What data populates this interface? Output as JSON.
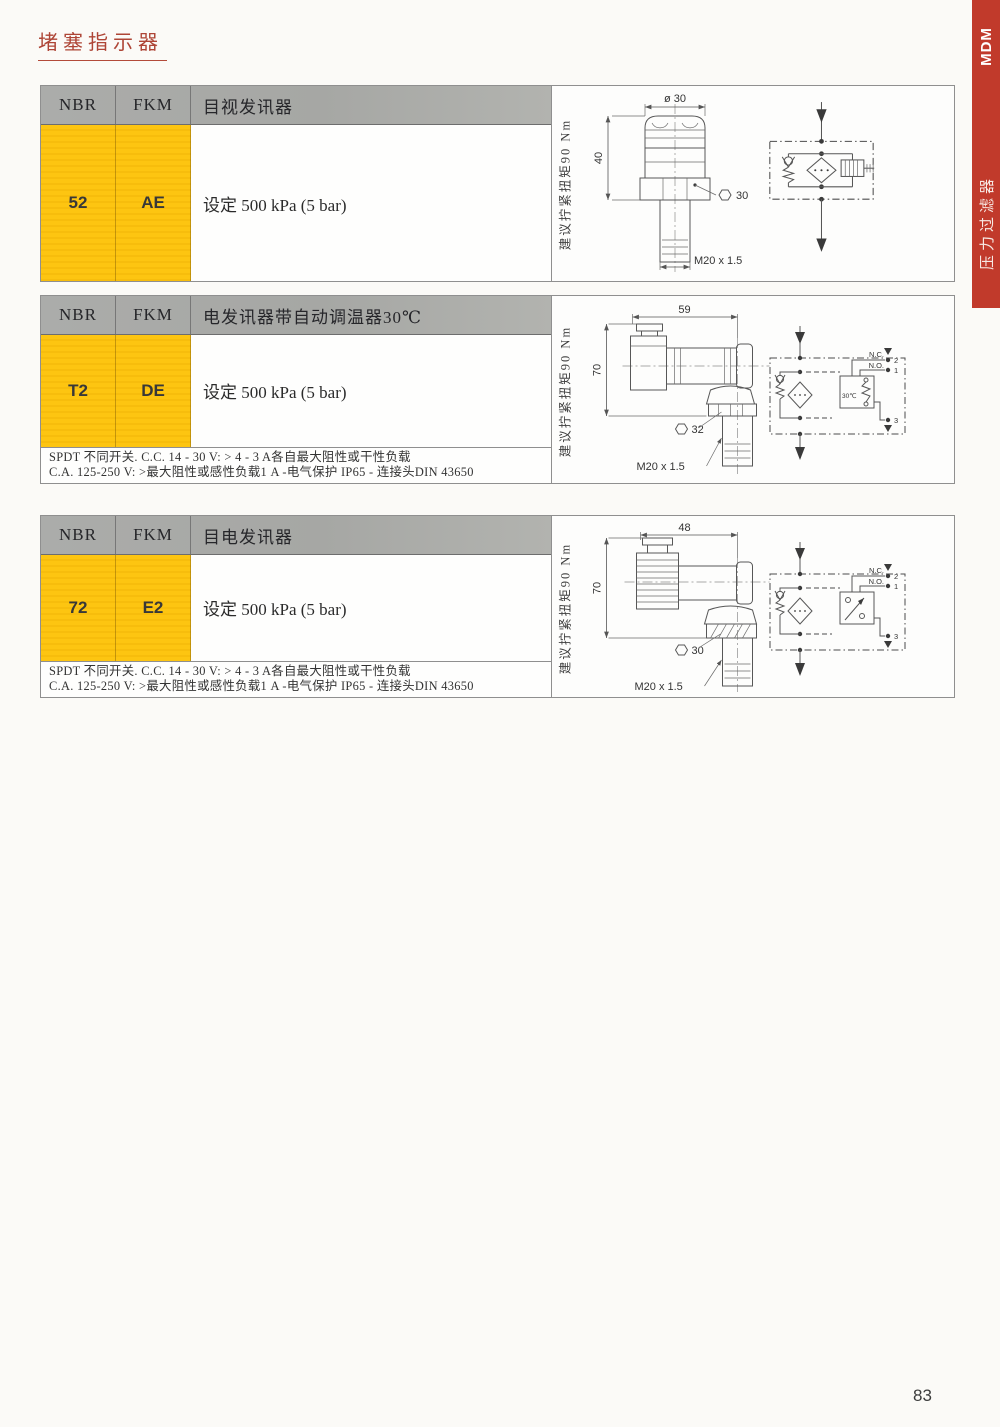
{
  "page": {
    "title": "堵塞指示器",
    "number": "83"
  },
  "sidebar": {
    "brand": "MDM",
    "category": "压力过滤器"
  },
  "colors": {
    "accent_red": "#c13a2b",
    "header_gray": "#a9aaa7",
    "cell_yellow": "#fdc511",
    "title_red": "#ae4536"
  },
  "sections": [
    {
      "header": {
        "nbr": "NBR",
        "fkm": "FKM",
        "title": "目视发讯器"
      },
      "row": {
        "nbr": "52",
        "fkm": "AE",
        "desc": "设定 500 kPa (5 bar)"
      },
      "torque": "建议拧紧扭矩90 Nm",
      "drawing": {
        "dim_top": "ø 30",
        "height": "40",
        "hex": "30",
        "thread": "M20 x 1.5"
      }
    },
    {
      "header": {
        "nbr": "NBR",
        "fkm": "FKM",
        "title": "电发讯器带自动调温器30℃"
      },
      "row": {
        "nbr": "T2",
        "fkm": "DE",
        "desc": "设定 500 kPa (5 bar)"
      },
      "notes": [
        "SPDT 不同开关. C.C. 14 - 30 V: > 4 - 3 A各自最大阻性或干性负载",
        "C.A. 125-250 V: >最大阻性或感性负载1 A -电气保护 IP65 - 连接头DIN 43650"
      ],
      "torque": "建议拧紧扭矩90 Nm",
      "drawing": {
        "dim_top": "59",
        "height": "70",
        "hex": "32",
        "thread": "M20 x 1.5"
      },
      "circuit": {
        "nc": "N.C.",
        "no": "N.O.",
        "t2": "2",
        "t1": "1",
        "t3": "3",
        "temp": "30℃"
      }
    },
    {
      "header": {
        "nbr": "NBR",
        "fkm": "FKM",
        "title": "目电发讯器"
      },
      "row": {
        "nbr": "72",
        "fkm": "E2",
        "desc": "设定 500 kPa (5 bar)"
      },
      "notes": [
        "SPDT 不同开关. C.C. 14 - 30 V: > 4 - 3 A各自最大阻性或干性负载",
        "C.A. 125-250 V: >最大阻性或感性负载1 A -电气保护 IP65 - 连接头DIN 43650"
      ],
      "torque": "建议拧紧扭矩90 Nm",
      "drawing": {
        "dim_top": "48",
        "height": "70",
        "hex": "30",
        "thread": "M20 x 1.5"
      },
      "circuit": {
        "nc": "N.C.",
        "no": "N.O.",
        "t2": "2",
        "t1": "1",
        "t3": "3"
      }
    }
  ]
}
